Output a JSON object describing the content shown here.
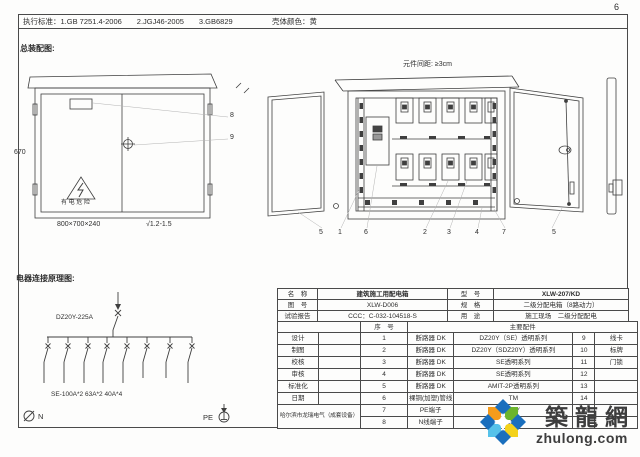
{
  "page": {
    "number": "6"
  },
  "header": {
    "standards": "执行标准：1.GB 7251.4-2006　　2.JGJ46-2005　　3.GB6829",
    "shell_color": "壳体颜色：黄"
  },
  "assembly": {
    "title": "总装配图:",
    "dim_height": "670",
    "dim_size": "800×700×240",
    "dim_thickness": "√1.2-1.5",
    "warning_label": "有 电 危 险",
    "callout_8": "8",
    "callout_9": "9",
    "spacing_note": "元件间距: ≥3cm",
    "part_numbers": [
      "5",
      "1",
      "6",
      "2",
      "3",
      "4",
      "7",
      "5"
    ]
  },
  "schematic": {
    "title": "电器连接原理图:",
    "main_breaker": "DZ20Y-225A",
    "branch_spec": "SE-100A*2  63A*2  40A*4",
    "neutral_label": "N",
    "pe_label": "PE"
  },
  "table": {
    "info": [
      {
        "l1": "名　称",
        "v1": "建筑施工用配电箱",
        "l2": "型　号",
        "v2": "XLW-207/KD"
      },
      {
        "l1": "图　号",
        "v1": "XLW-D006",
        "l2": "规　格",
        "v2": "二级分配电箱（8路动力）"
      },
      {
        "l1": "试验报告",
        "v1": "CCC：C-032-104518-S",
        "l2": "用　途",
        "v2": "施工现场　二级分配配电"
      }
    ],
    "header": {
      "serial": "序　号",
      "parts": "主要配件"
    },
    "rows": [
      {
        "role": "设计",
        "sign": "",
        "no": "1",
        "name": "断路器 DK",
        "spec": "DZ20Y（SE）透明系列",
        "no2": "9",
        "name2": "线卡"
      },
      {
        "role": "制图",
        "sign": "",
        "no": "2",
        "name": "断路器 DK",
        "spec": "DZ20Y（SDZ20Y）透明系列",
        "no2": "10",
        "name2": "标牌"
      },
      {
        "role": "校核",
        "sign": "",
        "no": "3",
        "name": "断路器 DK",
        "spec": "SE透明系列",
        "no2": "11",
        "name2": "门锁"
      },
      {
        "role": "审核",
        "sign": "",
        "no": "4",
        "name": "断路器 DK",
        "spec": "SE透明系列",
        "no2": "12",
        "name2": ""
      },
      {
        "role": "标准化",
        "sign": "",
        "no": "5",
        "name": "断路器 DK",
        "spec": "AMIT-2P透明系列",
        "no2": "13",
        "name2": ""
      },
      {
        "role": "日期",
        "sign": "",
        "no": "6",
        "name": "裸铜(加塑)管线",
        "spec": "TM",
        "no2": "14",
        "name2": ""
      },
      {
        "role": "",
        "sign": "",
        "no": "7",
        "name": "PE端子",
        "spec": "LMY",
        "no2": "15",
        "name2": ""
      },
      {
        "role": "",
        "sign": "",
        "no": "8",
        "name": "N线端子",
        "spec": "LMY",
        "no2": "",
        "name2": ""
      }
    ],
    "company": "哈尔滨市龙瑞电气（成套设备）"
  },
  "watermark": {
    "cn": "築龍網",
    "url": "zhulong.com",
    "colors": {
      "text": "#3d3d3d",
      "blue": "#1a6fbd",
      "orange": "#f59c1c",
      "green": "#6cb52d",
      "cyan": "#56c2ea",
      "yellow": "#f4d21b"
    }
  },
  "colors": {
    "line": "#3f3f3f",
    "leader": "#b3b3b3",
    "paper": "#fdfdfc"
  }
}
